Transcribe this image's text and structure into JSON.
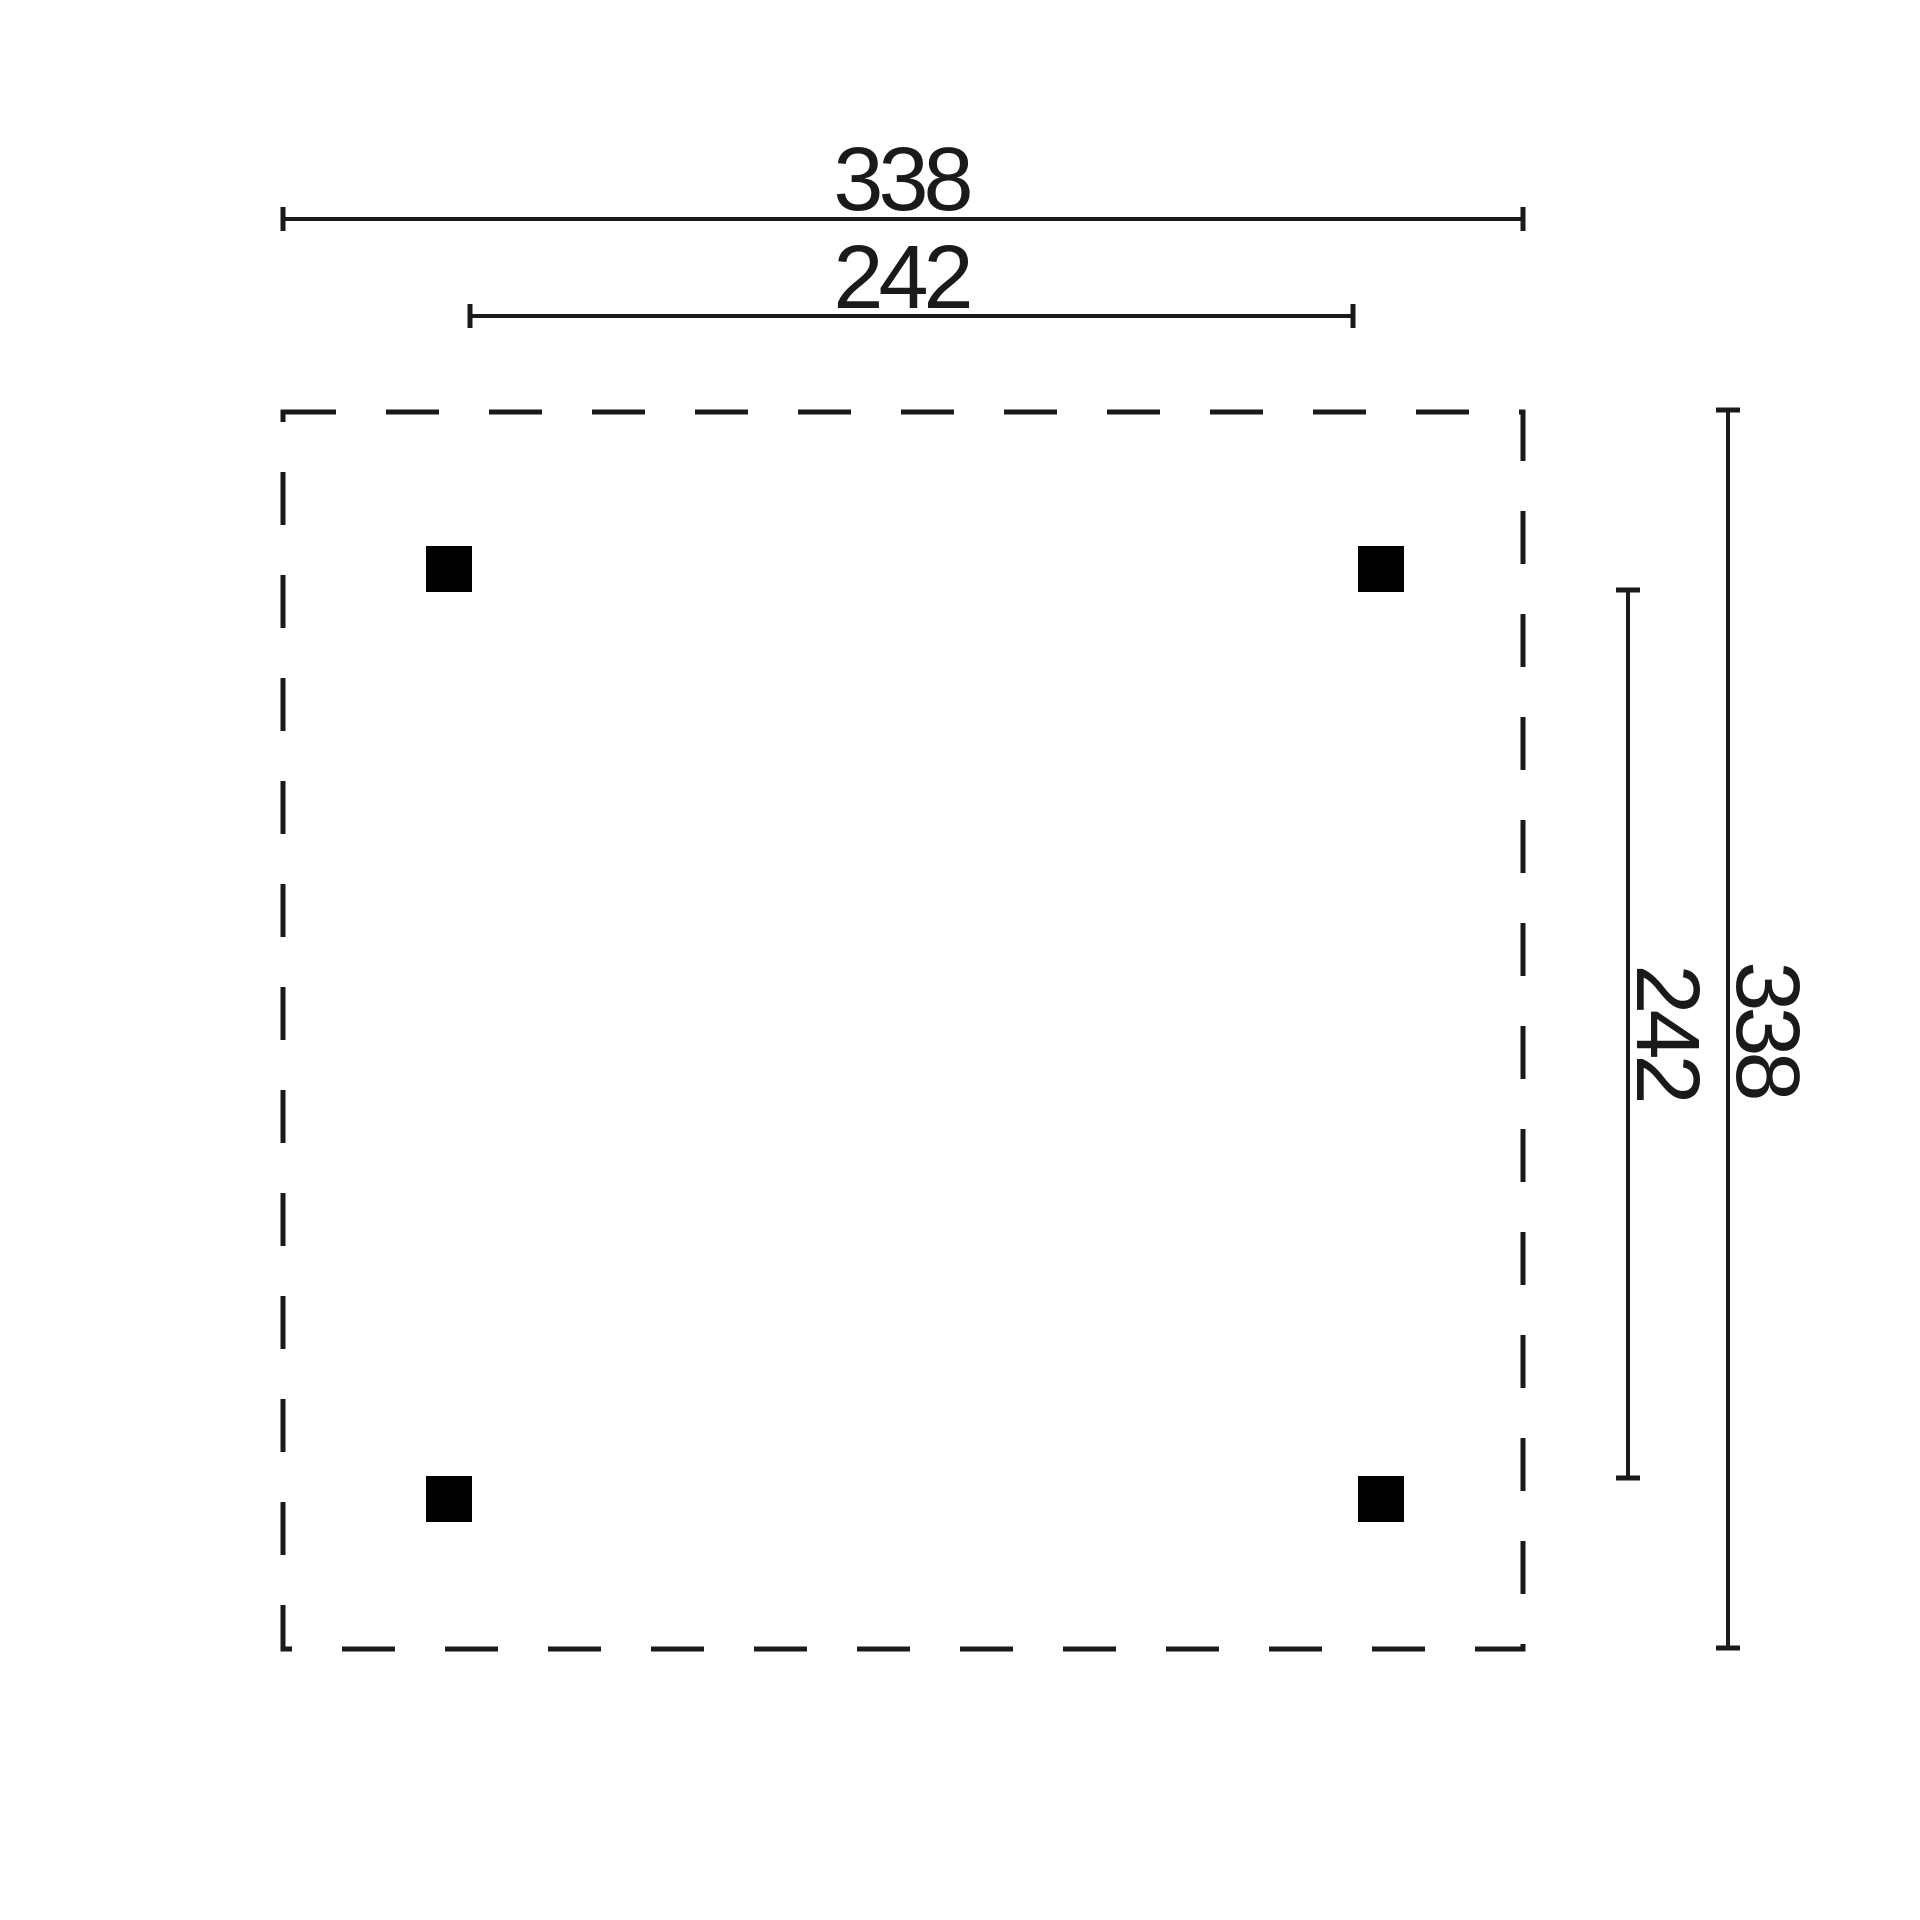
{
  "diagram": {
    "kind": "dimensioned-floor-plan",
    "labels": {
      "width_overall": "338",
      "width_inner": "242",
      "depth_inner": "242",
      "depth_overall": "338"
    },
    "posts": {
      "count": 4
    },
    "colors": {
      "background": "#ffffff",
      "line": "#1a1a1a",
      "post": "#000000"
    }
  }
}
